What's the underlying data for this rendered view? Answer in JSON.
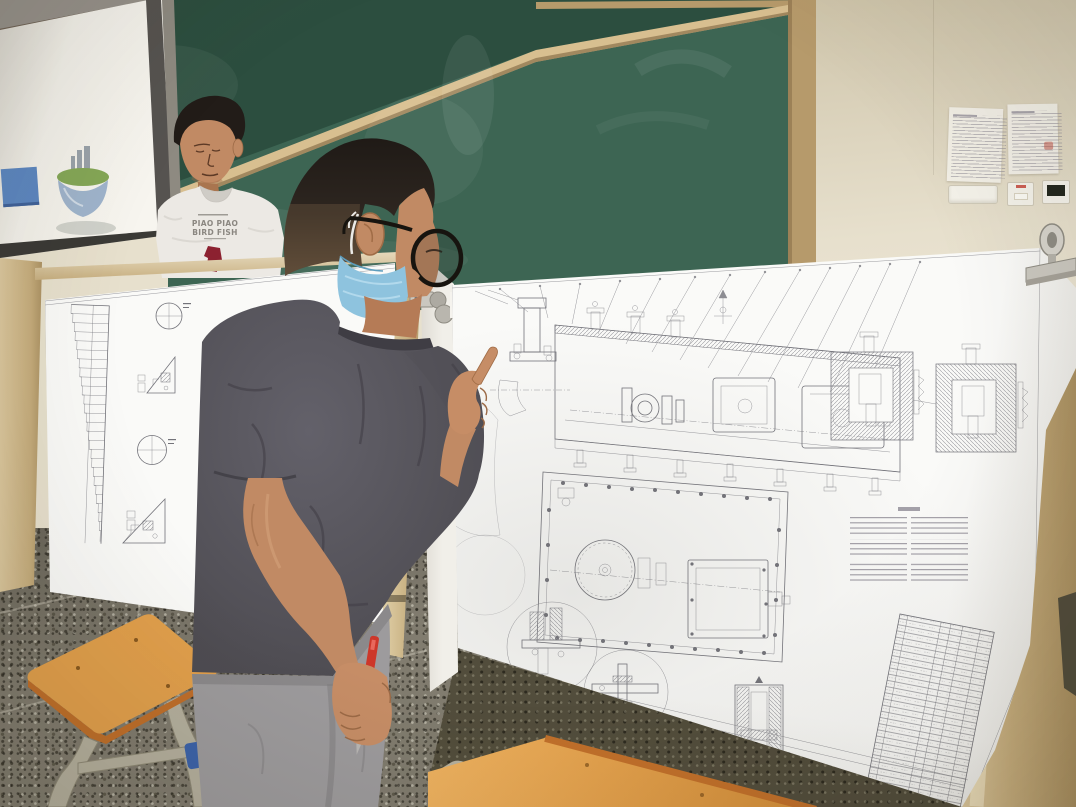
{
  "colors": {
    "ceiling": "#96918a",
    "ceiling_stripe": "#6f6356",
    "wall": "#e7e0cd",
    "wall_shadow": "#cfc5ab",
    "chalk_green": "#3d6553",
    "chalk_green_dark": "#2c4e3f",
    "frame_tan": "#b69a6b",
    "rail_light": "#d8bf90",
    "frame_shadow": "#8a714a",
    "screen_white": "#f3f1ea",
    "screen_dim": "#d8d5cd",
    "screen_bar": "#3b3a36",
    "pole_dark": "#565350",
    "pole_gray": "#8e8a81",
    "slide_blue": "#5d87c0",
    "island_green": "#85a757",
    "island_blue": "#8fa8c6",
    "island_gray": "#9aa2a9",
    "island_shadow": "#b8bab4",
    "paper_white": "#fafaf8",
    "drawing_line": "#73737a",
    "drawing_dark": "#4a4a50",
    "wood_light": "#dcc89e",
    "wood_mid": "#c5ac7c",
    "wood_dark": "#a98f60",
    "floor_base": "#817c6f",
    "grout": "#d9d5c6",
    "olive_dark": "#524d3c",
    "skin": "#c18a64",
    "skin_shadow": "#9c6a46",
    "skin_light": "#d8a57d",
    "hair": "#221c18",
    "hair_buzz": "#66513c",
    "shirt_dark": "#57555b",
    "shirt_fold": "#434148",
    "collar": "#3f3d44",
    "pants": "#9d9b9d",
    "pants_crease": "#7f7d80",
    "mask_blue": "#8ec3de",
    "mask_fold": "#b2d9ec",
    "mask_shadow": "#5d9dbd",
    "strap_white": "#ecebe7",
    "glasses": "#17140f",
    "pen_red": "#cd372a",
    "pen_tip": "#b9b7b5",
    "shirt_white": "#ece9e4",
    "shirt_white_shadow": "#cfccc6",
    "tee_text": "#8b8781",
    "graphic_red": "#8c2130",
    "seat_orange": "#e2a04c",
    "seat_edge": "#c06f2a",
    "leg_metal": "#b5b09e",
    "foot_blue": "#3c63aa",
    "clip_silver": "#cac7bf",
    "clip_dark": "#8f8c83",
    "notice_white": "#f2efe6",
    "notice_text": "#8f8b95",
    "stamp_red": "#c05548",
    "device_white": "#f4f2ea",
    "device_screen": "#23281f",
    "device_red": "#c23b30"
  },
  "presenter": {
    "shirt_line1": "PIAO PIAO",
    "shirt_line2": "BIRD FISH"
  }
}
